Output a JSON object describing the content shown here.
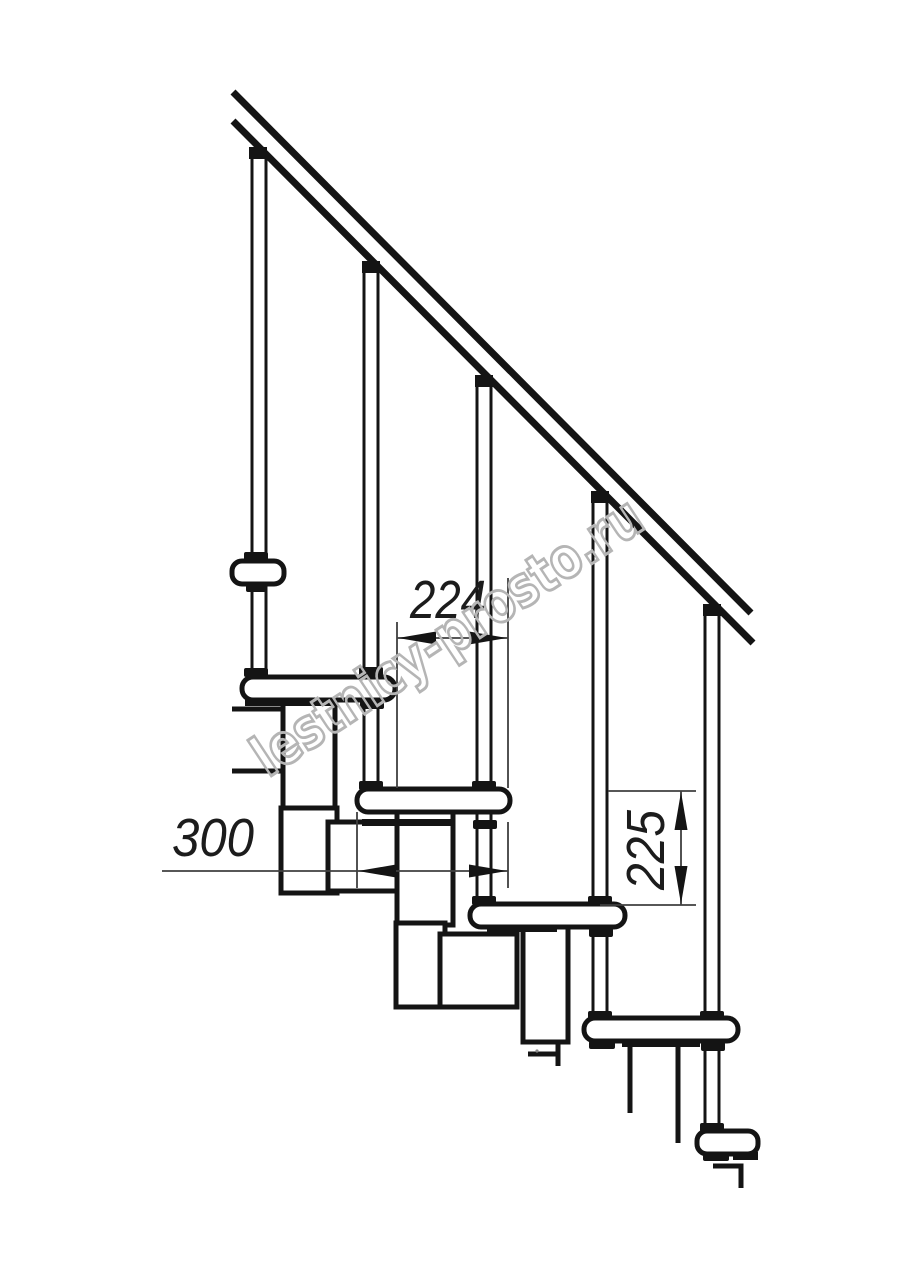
{
  "drawing": {
    "type": "staircase-side-elevation",
    "description": "Modular staircase technical drawing with handrail, balusters, treads and support modules",
    "labels": {
      "dim_run": "224",
      "dim_depth": "300",
      "dim_rise": "225"
    },
    "dimensions": [
      {
        "id": "step-run",
        "value": 224,
        "orientation": "horizontal"
      },
      {
        "id": "tread-depth",
        "value": 300,
        "orientation": "horizontal"
      },
      {
        "id": "step-rise",
        "value": 225,
        "orientation": "vertical"
      }
    ],
    "watermark": "lestnicy-prosto.ru",
    "colors": {
      "line": "#141414",
      "dimension_line": "#3f3f3f",
      "watermark": "#b5b5b5",
      "background": "#ffffff"
    },
    "counts": {
      "balusters": 5,
      "treads": 6
    }
  }
}
